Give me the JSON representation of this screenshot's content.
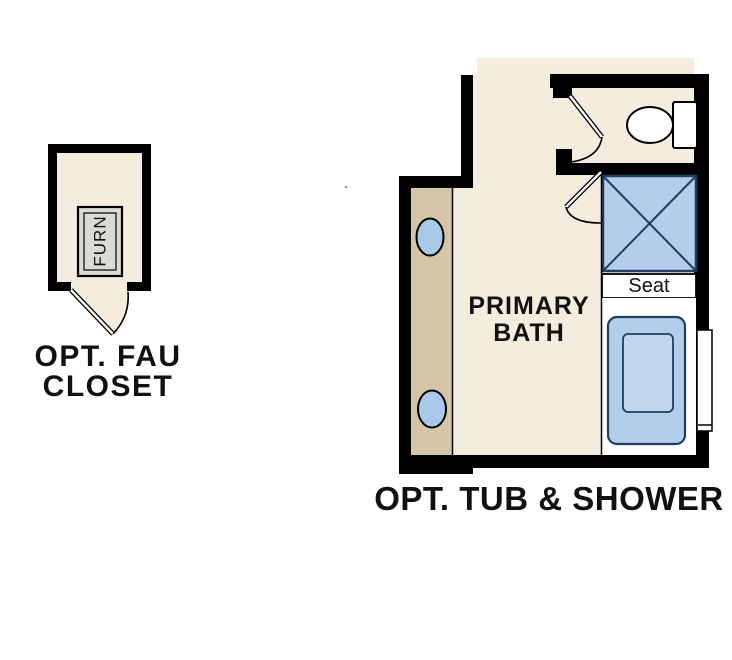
{
  "diagram": {
    "type": "architectural-floor-plan",
    "areas": [
      {
        "name": "optional FAU closet",
        "caption_line1": "OPT. FAU",
        "caption_line2": "CLOSET"
      },
      {
        "name": "primary bathroom with optional tub and shower",
        "caption": "OPT. TUB & SHOWER"
      }
    ],
    "labels": {
      "closet_line1": "OPT. FAU",
      "closet_line2": "CLOSET",
      "furnace": "FURN",
      "room_line1": "PRIMARY",
      "room_line2": "BATH",
      "seat": "Seat",
      "caption": "OPT. TUB & SHOWER"
    },
    "fixtures": [
      "furnace-unit",
      "toilet",
      "shower-with-x",
      "shower-seat",
      "bathtub",
      "vanity-counter",
      "sink-oval-top",
      "sink-oval-bottom",
      "window-by-tub",
      "swing-door-closet",
      "swing-door-water-closet",
      "swing-door-shower"
    ],
    "colors": {
      "floor_cream": "#f4edde",
      "vanity_tan": "#d5c5a6",
      "wall_black": "#000000",
      "shower_blue": "#b4cde9",
      "tub_blue": "#b2cee9",
      "tub_blue_inner": "#c0d7ee",
      "blue_line": "#1e3e62",
      "sink_blue": "#a9c9e9",
      "furn_grey": "#dadbd3",
      "white": "#ffffff",
      "text_black": "#111111"
    }
  }
}
